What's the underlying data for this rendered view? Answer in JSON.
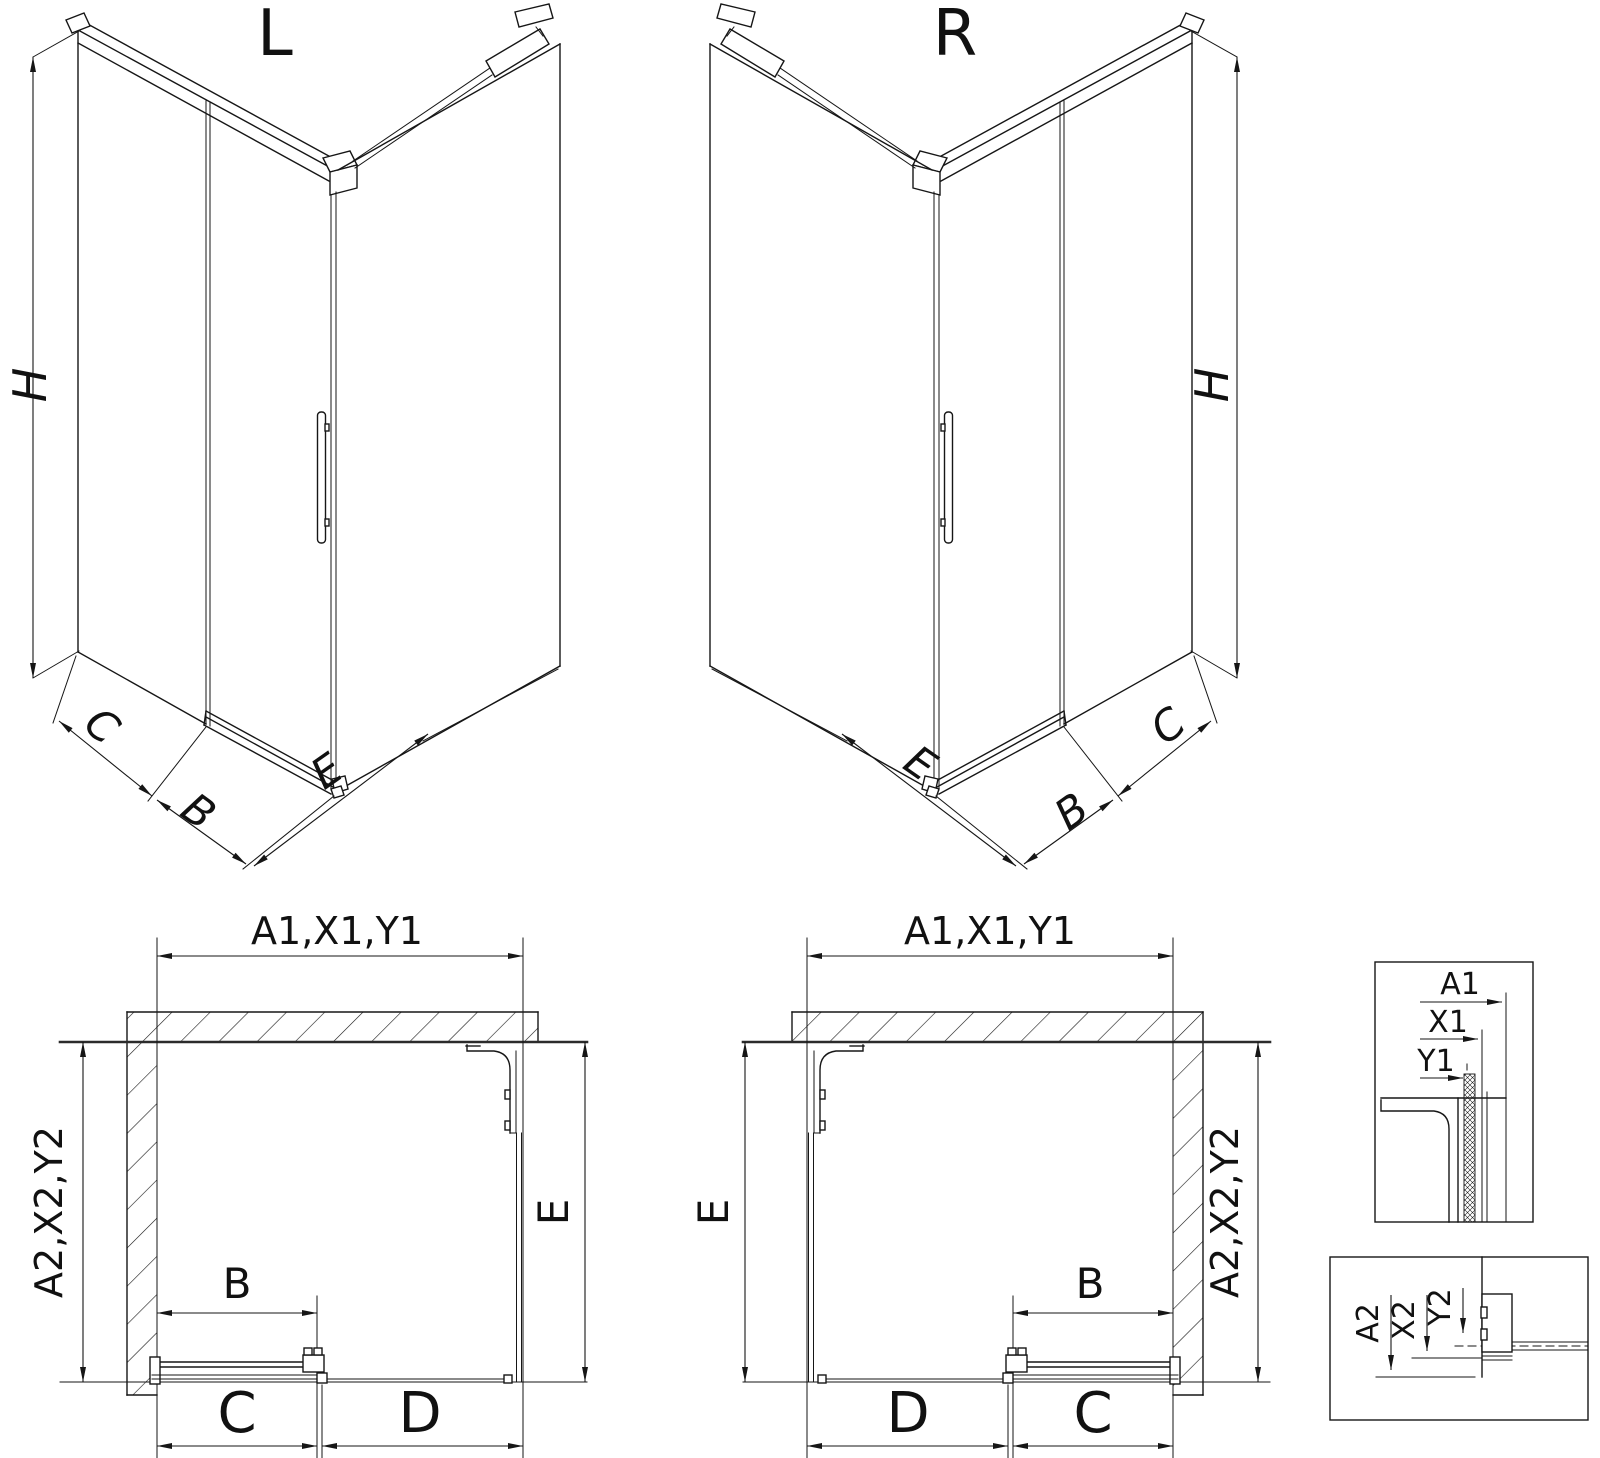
{
  "iso_left": {
    "title": "L",
    "dim_height": "H",
    "dim_side": "C",
    "dim_door": "B",
    "dim_panel": "E"
  },
  "iso_right": {
    "title": "R",
    "dim_height": "H",
    "dim_side": "C",
    "dim_door": "B",
    "dim_panel": "E"
  },
  "plan_left": {
    "dim_top": "A1,X1,Y1",
    "dim_side": "A2,X2,Y2",
    "dim_depth": "E",
    "dim_door": "B",
    "dim_c": "C",
    "dim_d": "D"
  },
  "plan_right": {
    "dim_top": "A1,X1,Y1",
    "dim_side": "A2,X2,Y2",
    "dim_depth": "E",
    "dim_door": "B",
    "dim_c": "C",
    "dim_d": "D"
  },
  "detail_top": {
    "dim_a": "A1",
    "dim_x": "X1",
    "dim_y": "Y1"
  },
  "detail_bottom": {
    "dim_a": "A2",
    "dim_x": "X2",
    "dim_y": "Y2"
  }
}
